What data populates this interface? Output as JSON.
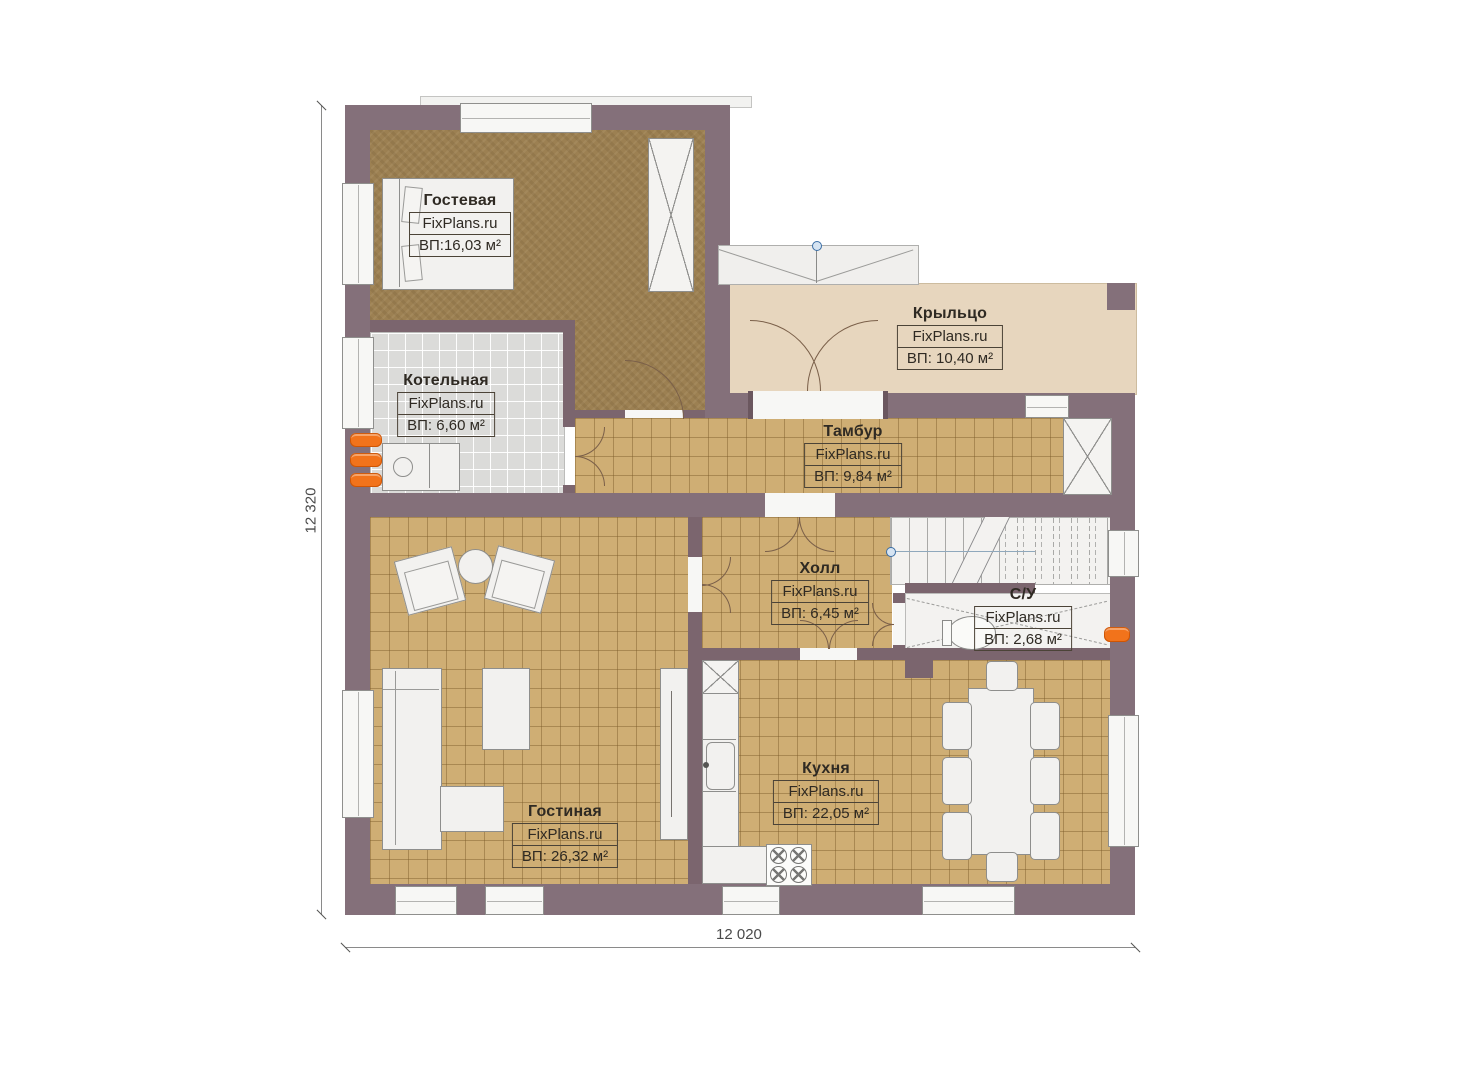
{
  "plan": {
    "title": "floor plan",
    "brand": "FixPlans.ru",
    "dimensions": {
      "left": "12 320",
      "bottom": "12 020"
    },
    "rooms": [
      {
        "name": "Гостевая",
        "brand": "FixPlans.ru",
        "area": "ВП:16,03 м²"
      },
      {
        "name": "Котельная",
        "brand": "FixPlans.ru",
        "area": "ВП: 6,60 м²"
      },
      {
        "name": "Крыльцо",
        "brand": "FixPlans.ru",
        "area": "ВП: 10,40 м²"
      },
      {
        "name": "Тамбур",
        "brand": "FixPlans.ru",
        "area": "ВП: 9,84 м²"
      },
      {
        "name": "Холл",
        "brand": "FixPlans.ru",
        "area": "ВП: 6,45 м²"
      },
      {
        "name": "С/У",
        "brand": "FixPlans.ru",
        "area": "ВП: 2,68 м²"
      },
      {
        "name": "Гостиная",
        "brand": "FixPlans.ru",
        "area": "ВП: 26,32 м²"
      },
      {
        "name": "Кухня",
        "brand": "FixPlans.ru",
        "area": "ВП: 22,05 м²"
      }
    ],
    "colors": {
      "wall": "#84707A",
      "floor_tile": "#CFAE74",
      "floor_carpet": "#9C8052",
      "floor_boiler": "#DBDBD9",
      "floor_porch": "#E7D6BE",
      "radiator_orange": "#F2731B",
      "marker_blue": "#3B6EA5"
    }
  }
}
